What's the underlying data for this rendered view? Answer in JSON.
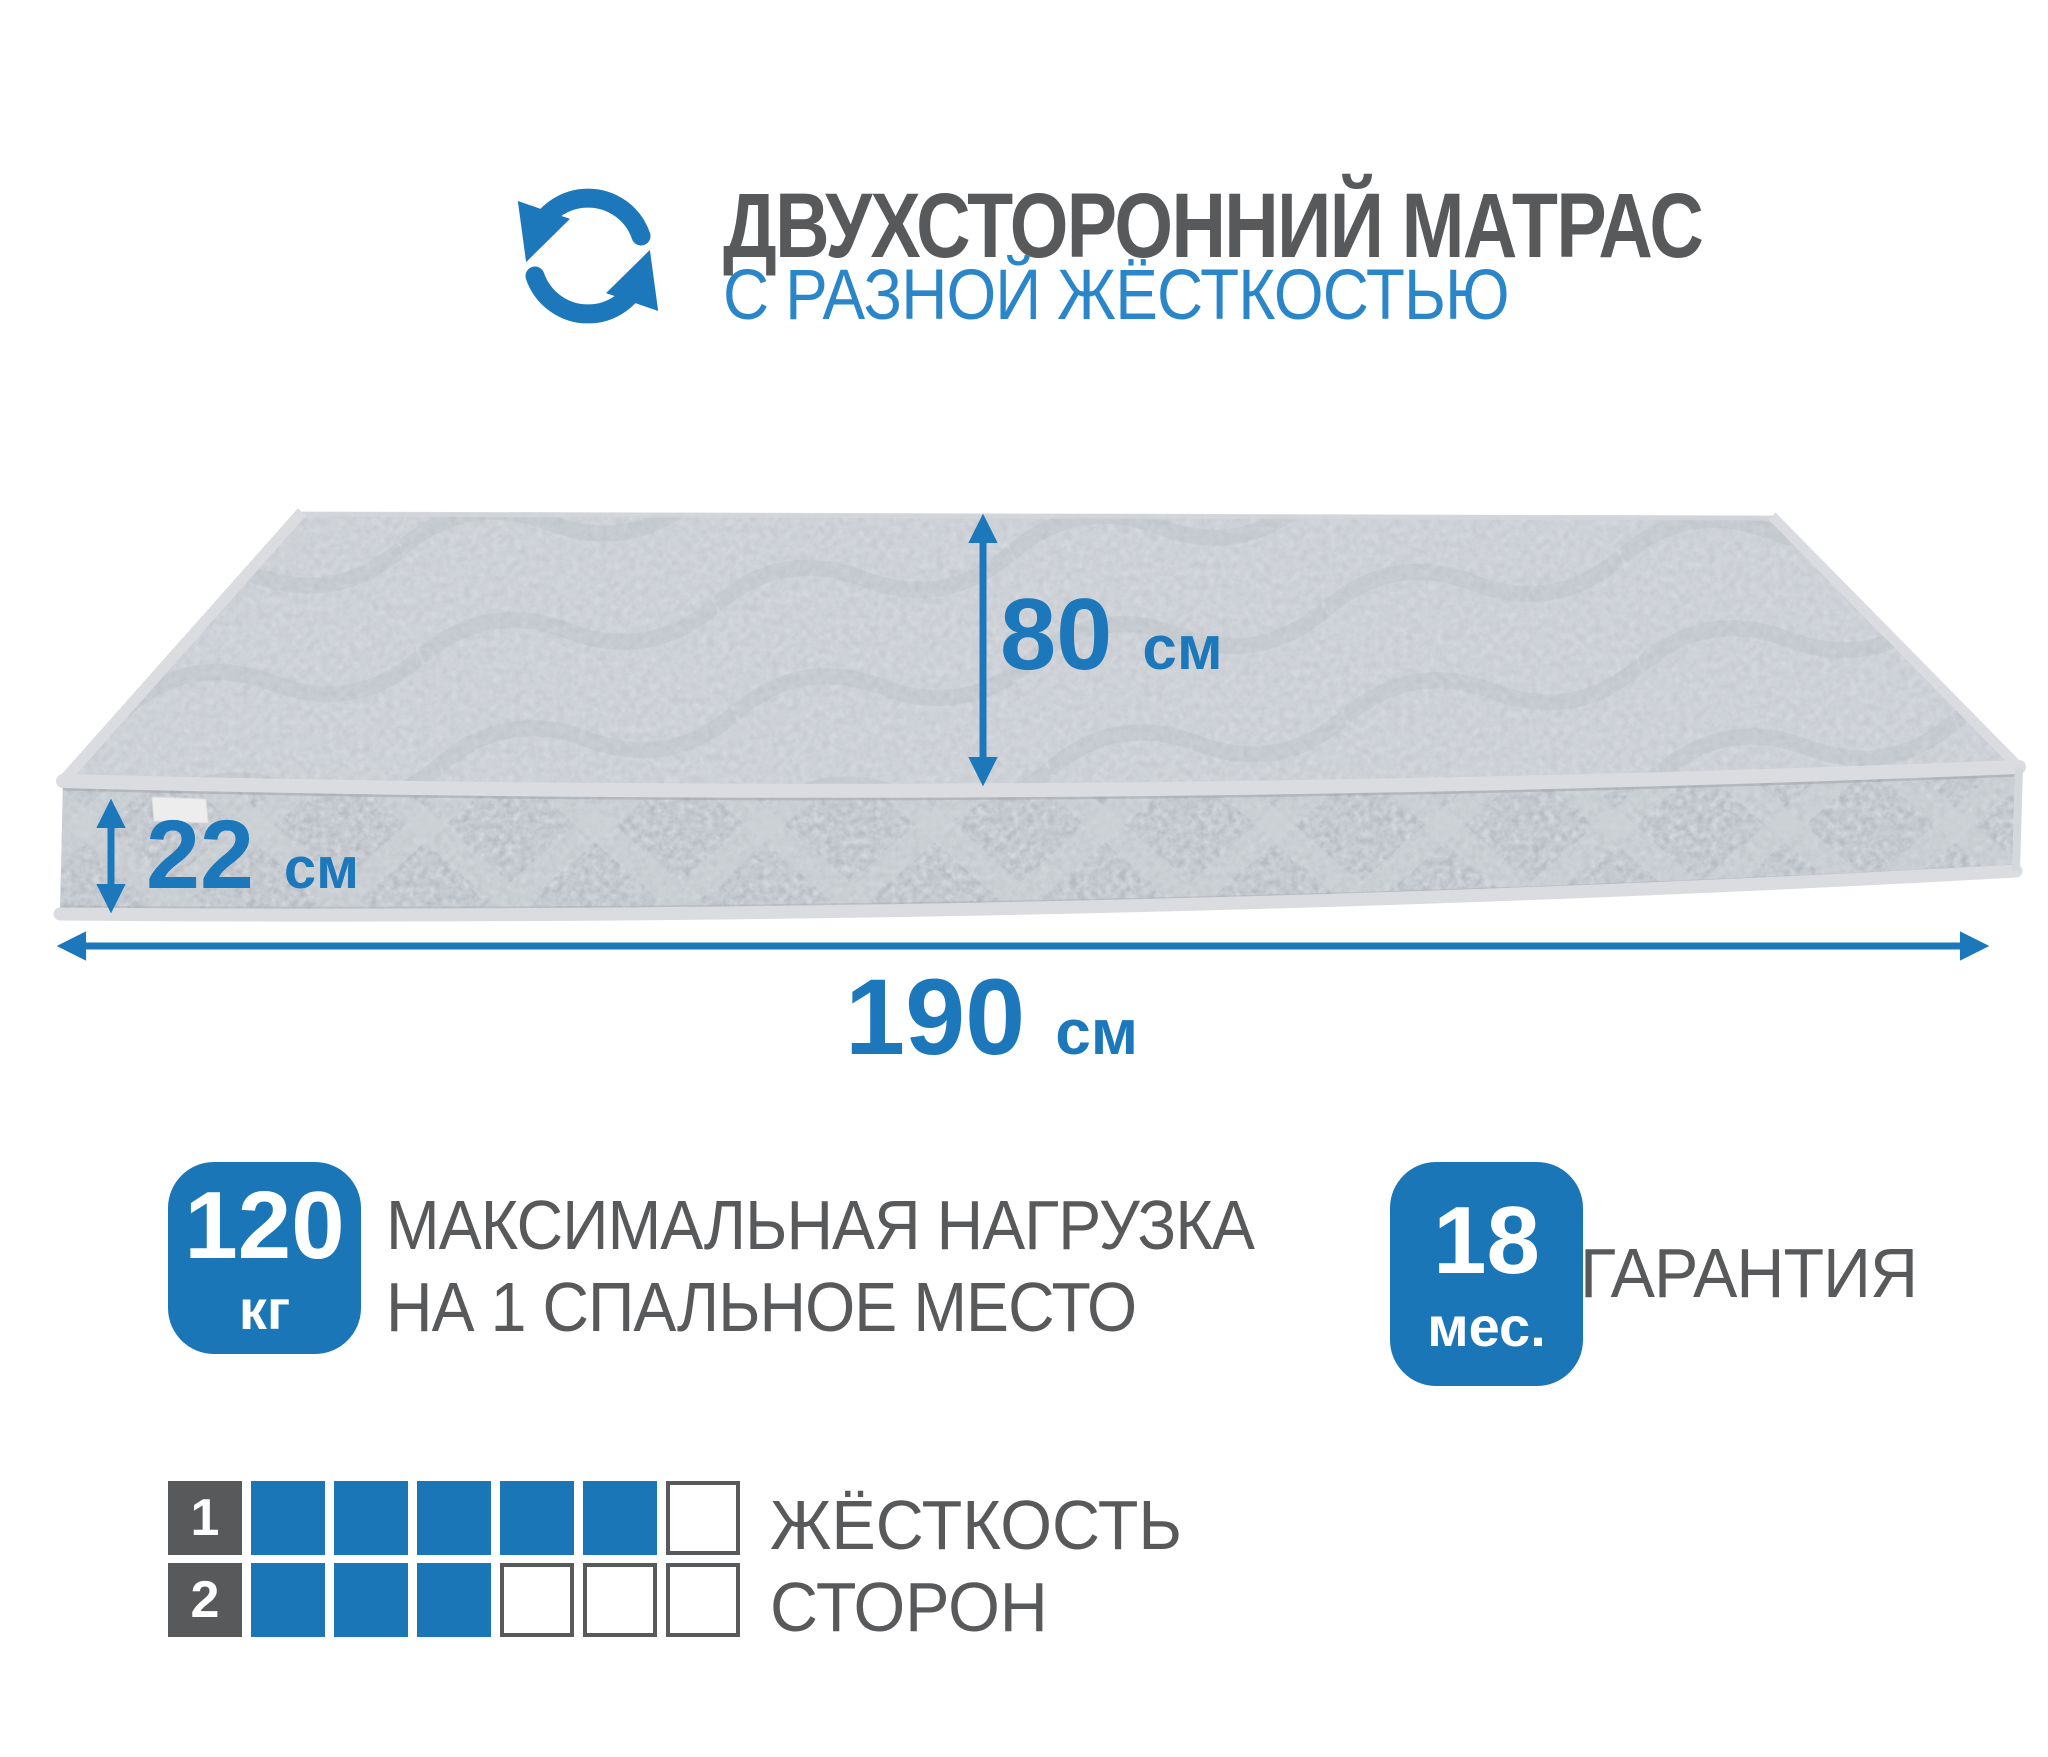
{
  "colors": {
    "accent_blue": "#1c78bb",
    "badge_blue": "#1b76b8",
    "subtitle_blue": "#2a86c8",
    "text_gray": "#58595b",
    "mattress_top_gray": "#c7cbd0",
    "mattress_side_gray": "#b6bbc1",
    "piping_gray": "#dadce0"
  },
  "header": {
    "icon": "rotate-arrows-icon",
    "title": "ДВУХСТОРОННИЙ МАТРАС",
    "subtitle": "С РАЗНОЙ ЖЁСТКОСТЬЮ"
  },
  "mattress": {
    "dimensions": {
      "width": {
        "value": "80",
        "unit": "см"
      },
      "height": {
        "value": "22",
        "unit": "см"
      },
      "length": {
        "value": "190",
        "unit": "см"
      }
    }
  },
  "badges": {
    "max_load": {
      "value": "120",
      "unit": "кг",
      "label_line1": "МАКСИМАЛЬНАЯ НАГРУЗКА",
      "label_line2": "НА 1 СПАЛЬНОЕ МЕСТО"
    },
    "warranty": {
      "value": "18",
      "unit": "мес.",
      "label": "ГАРАНТИЯ"
    }
  },
  "firmness": {
    "label_line1": "ЖЁСТКОСТЬ",
    "label_line2": "СТОРОН",
    "rows": [
      {
        "side": "1",
        "filled": 5,
        "total": 6
      },
      {
        "side": "2",
        "filled": 3,
        "total": 6
      }
    ]
  }
}
